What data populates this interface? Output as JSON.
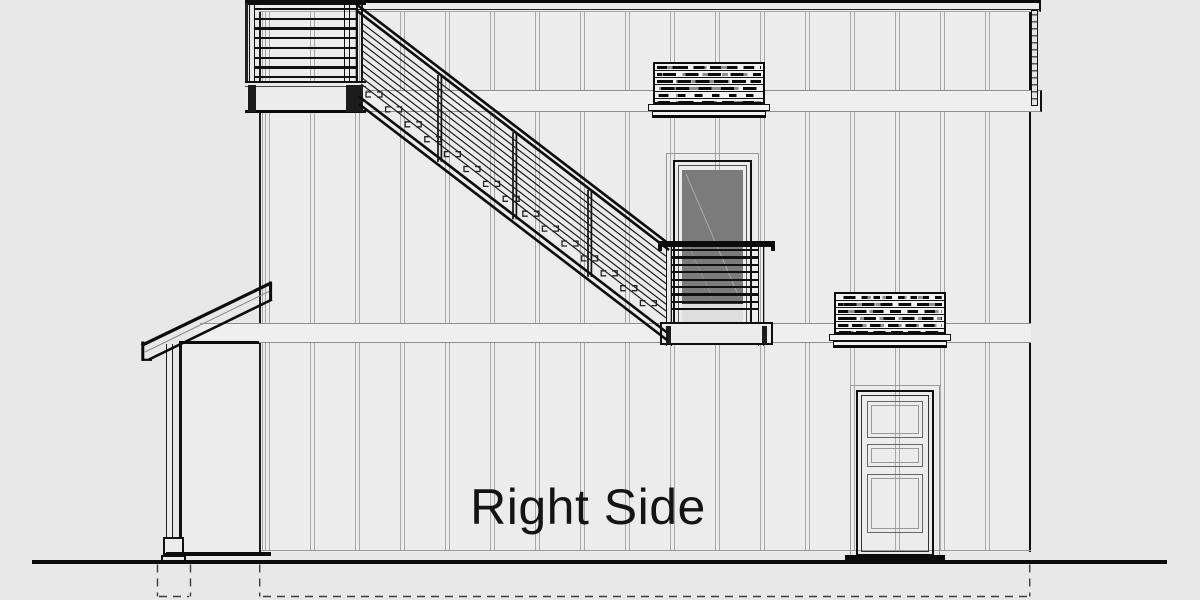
{
  "drawing": {
    "label": "Right Side",
    "view": "architectural side elevation of a two-story house with exterior stair",
    "features": {
      "deck_rail_count": 8,
      "balcony_rail_count": 9,
      "stair_cable_count": 10,
      "stair_post_count": 3,
      "stair_tread_mark_count": 15,
      "vent_slat_row_count": 6
    }
  },
  "colors": {
    "background": "#e8e8e8",
    "wall": "#ececec",
    "band": "#efefef",
    "line": "#111111",
    "batten": "#a8a8a8",
    "glass": "#7b7b7b"
  }
}
